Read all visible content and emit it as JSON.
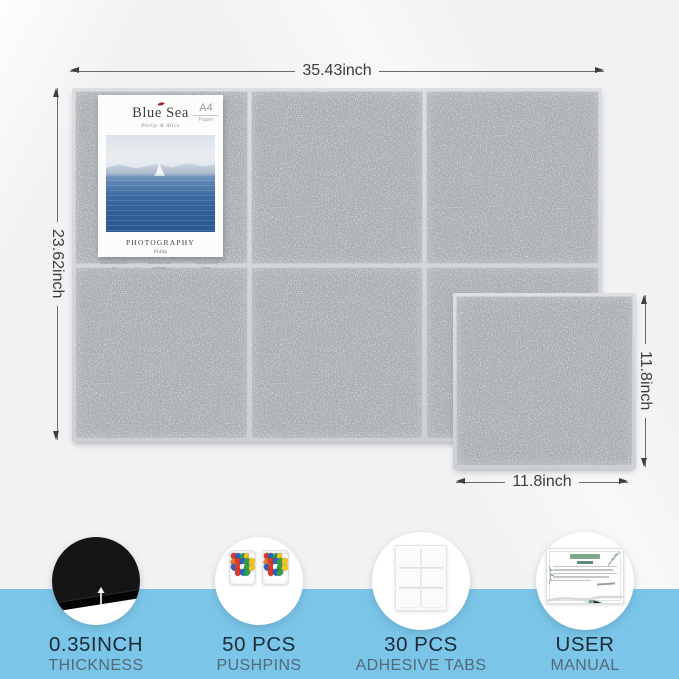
{
  "scene": {
    "background_color": "#f3f3f4",
    "accent_band_color": "#7ac5e8",
    "felt_color": "#a6abb0"
  },
  "board": {
    "width_label": "35.43inch",
    "height_label": "23.62inch",
    "grid": "2x3"
  },
  "tile": {
    "width_label": "11.8inch",
    "height_label": "11.8inch"
  },
  "poster": {
    "title": "Blue Sea",
    "subtitle": "Philip & Alice",
    "paper_badge_size": "A4",
    "paper_badge_word": "Paper",
    "category": "PHOTOGRAPHY",
    "author": "Philip",
    "footnotes": [
      "Blue sea photo by",
      "Blue sea and sailboat",
      "Supported by Sony"
    ],
    "footnote_separator": "|"
  },
  "features": [
    {
      "line1": "0.35INCH",
      "line2": "THICKNESS"
    },
    {
      "line1": "50 PCS",
      "line2": "PUSHPINS"
    },
    {
      "line1": "30 PCS",
      "line2": "ADHESIVE TABS"
    },
    {
      "line1": "USER",
      "line2": "MANUAL"
    }
  ],
  "pushpin_colors": [
    "#d93a2b",
    "#2b5fc2",
    "#2f9e4e",
    "#f2c21f",
    "#ffffff",
    "#e8782a",
    "#d93a2b",
    "#2b5fc2",
    "#2f9e4e",
    "#f2c21f",
    "#2b5fc2",
    "#d93a2b",
    "#ffffff",
    "#2f9e4e",
    "#f2c21f",
    "#d93a2b",
    "#2b5fc2",
    "#2f9e4e"
  ]
}
